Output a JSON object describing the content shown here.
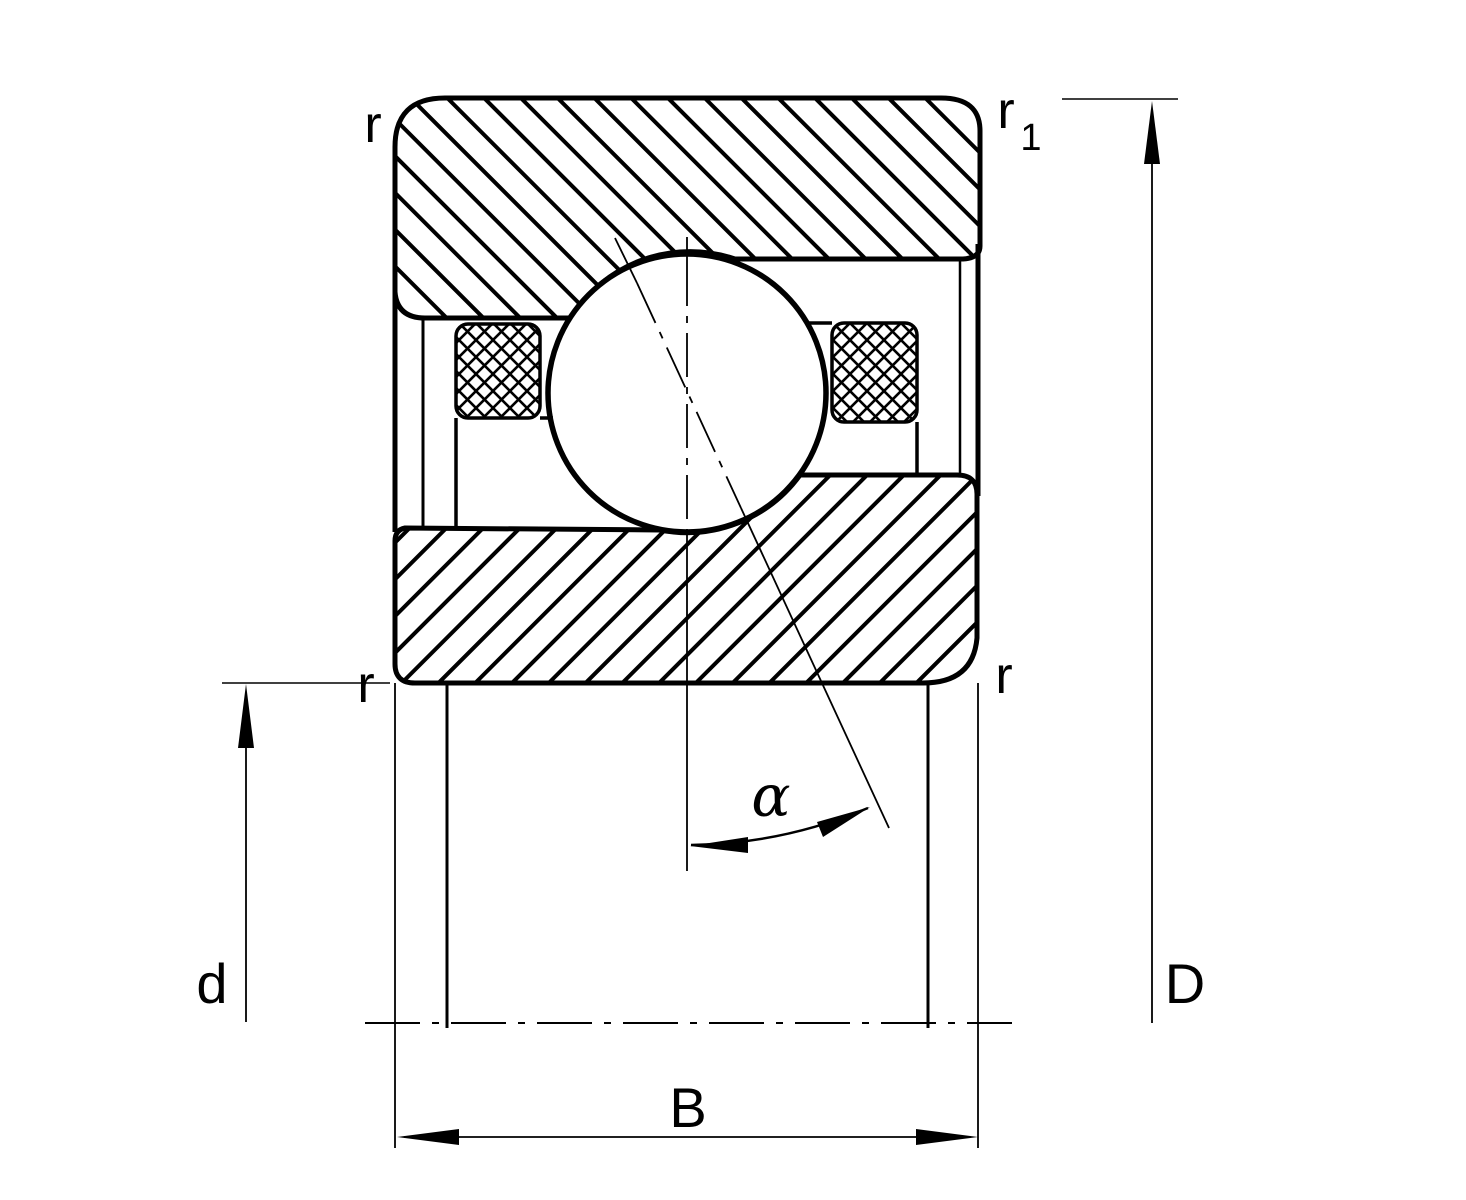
{
  "labels": {
    "chamfer_top_left": "r",
    "chamfer_top_right": "r",
    "chamfer_top_right_sub": "1",
    "chamfer_bottom_left": "r",
    "chamfer_bottom_right": "r",
    "contact_angle": "α",
    "bore_diameter": "d",
    "outside_diameter": "D",
    "width": "B"
  },
  "colors": {
    "line": "#000000",
    "background": "#ffffff"
  }
}
